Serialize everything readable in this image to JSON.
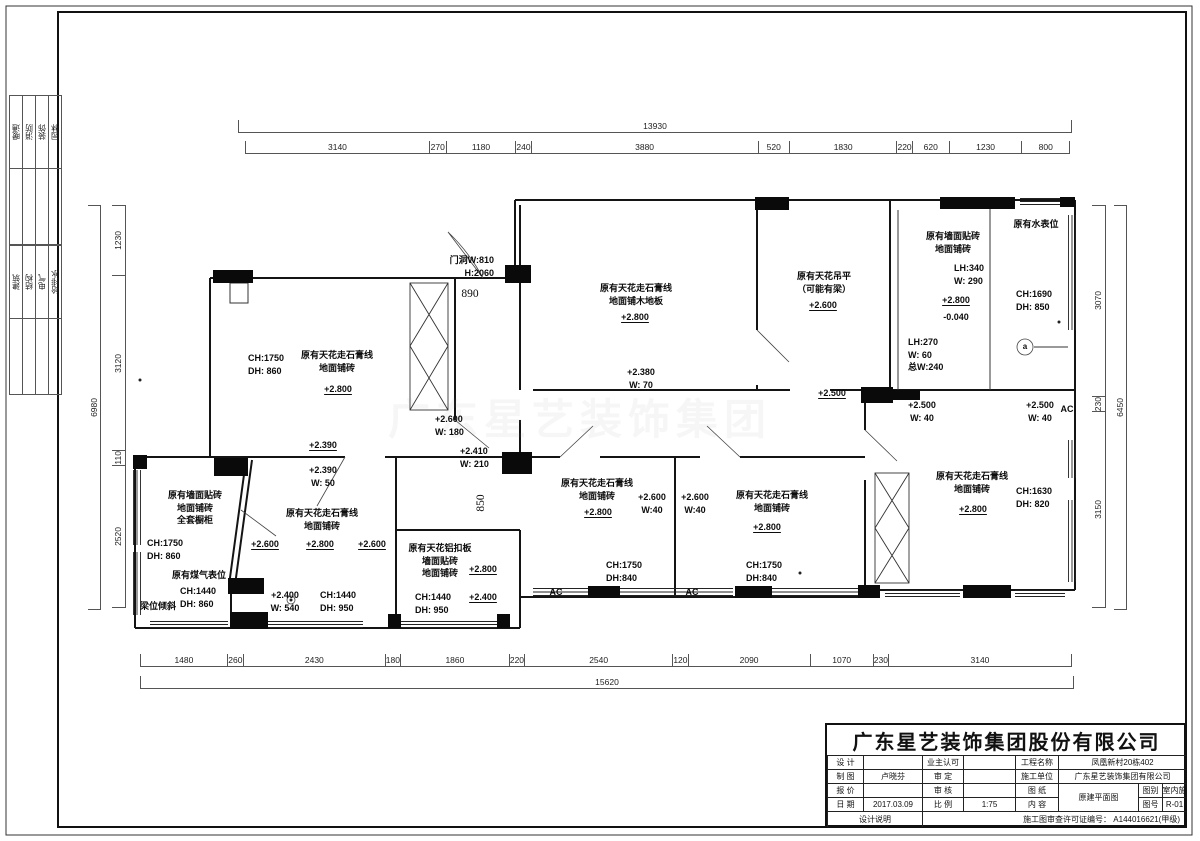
{
  "page": {
    "watermark": "广东星艺装饰集团",
    "margin_disciplines_group1": [
      {
        "t": "暖通"
      },
      {
        "t": "消防"
      },
      {
        "t": "装饰"
      },
      {
        "t": "园林"
      }
    ],
    "margin_disciplines_group2": [
      {
        "t": "建筑"
      },
      {
        "t": "结构"
      },
      {
        "t": "电气"
      },
      {
        "t": "给排水"
      }
    ]
  },
  "dims": {
    "top": {
      "total": "13930",
      "segments": [
        {
          "label": "3140",
          "mm": 3140
        },
        {
          "label": "270",
          "mm": 270
        },
        {
          "label": "1180",
          "mm": 1180
        },
        {
          "label": "240",
          "mm": 240
        },
        {
          "label": "3880",
          "mm": 3880
        },
        {
          "label": "520",
          "mm": 520
        },
        {
          "label": "1830",
          "mm": 1830
        },
        {
          "label": "220",
          "mm": 220
        },
        {
          "label": "620",
          "mm": 620
        },
        {
          "label": "1230",
          "mm": 1230
        },
        {
          "label": "800",
          "mm": 800
        }
      ]
    },
    "bottom": {
      "total": "15620",
      "segments": [
        {
          "label": "1480",
          "mm": 1480
        },
        {
          "label": "260",
          "mm": 260
        },
        {
          "label": "2430",
          "mm": 2430
        },
        {
          "label": "180",
          "mm": 180
        },
        {
          "label": "1860",
          "mm": 1860
        },
        {
          "label": "220",
          "mm": 220
        },
        {
          "label": "2540",
          "mm": 2540
        },
        {
          "label": "120",
          "mm": 120
        },
        {
          "label": "2090",
          "mm": 2090
        },
        {
          "label": "1070",
          "mm": 1070
        },
        {
          "label": "230",
          "mm": 230
        },
        {
          "label": "3140",
          "mm": 3140
        }
      ]
    },
    "left": {
      "total": "6980",
      "segments": [
        {
          "label": "1230",
          "mm": 1230
        },
        {
          "label": "3120",
          "mm": 3120
        },
        {
          "label": "110",
          "mm": 110
        },
        {
          "label": "2520",
          "mm": 2520
        }
      ]
    },
    "right": {
      "total": "6450",
      "segments": [
        {
          "label": "3070",
          "mm": 3070
        },
        {
          "label": "230",
          "mm": 230
        },
        {
          "label": "3150",
          "mm": 3150
        }
      ]
    }
  },
  "plan_labels": [
    {
      "t": "门洞W:810\nH:2060",
      "x": 438,
      "y": 254,
      "w": 56,
      "cls": "right"
    },
    {
      "t": "890",
      "x": 450,
      "y": 286,
      "w": 40,
      "cls": "serif"
    },
    {
      "t": "CH:1750\nDH: 860",
      "x": 248,
      "y": 352,
      "w": 48,
      "cls": "left"
    },
    {
      "t": "原有天花走石膏线\n地面铺砖",
      "x": 293,
      "y": 349,
      "w": 88
    },
    {
      "t": "+2.800",
      "x": 315,
      "y": 383,
      "w": 46,
      "cls": "elev"
    },
    {
      "t": "+2.600\nW: 180",
      "x": 435,
      "y": 413,
      "w": 48,
      "cls": "left"
    },
    {
      "t": "+2.410\nW: 210",
      "x": 460,
      "y": 445,
      "w": 48,
      "cls": "left"
    },
    {
      "t": "+2.390",
      "x": 300,
      "y": 439,
      "w": 46,
      "cls": "elev"
    },
    {
      "t": "+2.390\nW: 50",
      "x": 298,
      "y": 464,
      "w": 50
    },
    {
      "t": "850",
      "x": 466,
      "y": 495,
      "w": 30,
      "cls": "serif vert"
    },
    {
      "t": "原有天花走石膏线\n地面铺木地板",
      "x": 588,
      "y": 282,
      "w": 96
    },
    {
      "t": "+2.800",
      "x": 612,
      "y": 311,
      "w": 46,
      "cls": "elev"
    },
    {
      "t": "+2.380\nW: 70",
      "x": 616,
      "y": 366,
      "w": 50
    },
    {
      "t": "原有天花吊平\n（可能有梁）",
      "x": 786,
      "y": 270,
      "w": 76
    },
    {
      "t": "+2.600",
      "x": 800,
      "y": 299,
      "w": 46,
      "cls": "elev"
    },
    {
      "t": "+2.500",
      "x": 810,
      "y": 387,
      "w": 44,
      "cls": "elev"
    },
    {
      "t": "原有墙面贴砖\n地面铺砖",
      "x": 918,
      "y": 230,
      "w": 70
    },
    {
      "t": "原有水表位",
      "x": 1006,
      "y": 218,
      "w": 60
    },
    {
      "t": "LH:340\nW: 290",
      "x": 954,
      "y": 262,
      "w": 44,
      "cls": "left"
    },
    {
      "t": "+2.800",
      "x": 933,
      "y": 294,
      "w": 46,
      "cls": "elev"
    },
    {
      "t": "-0.040",
      "x": 933,
      "y": 311,
      "w": 46
    },
    {
      "t": "CH:1690\nDH: 850",
      "x": 1016,
      "y": 288,
      "w": 48,
      "cls": "left"
    },
    {
      "t": "LH:270\nW:  60\n总W:240",
      "x": 908,
      "y": 336,
      "w": 50,
      "cls": "left"
    },
    {
      "t": "a",
      "x": 1017,
      "y": 341,
      "w": 16,
      "cls": "small"
    },
    {
      "t": "+2.500\nW: 40",
      "x": 898,
      "y": 399,
      "w": 48
    },
    {
      "t": "+2.500\nW: 40",
      "x": 1016,
      "y": 399,
      "w": 48
    },
    {
      "t": "AC",
      "x": 1056,
      "y": 403,
      "w": 22
    },
    {
      "t": "原有天花走石膏线\n地面铺砖",
      "x": 928,
      "y": 470,
      "w": 88
    },
    {
      "t": "+2.800",
      "x": 950,
      "y": 503,
      "w": 46,
      "cls": "elev"
    },
    {
      "t": "CH:1630\nDH: 820",
      "x": 1016,
      "y": 485,
      "w": 48,
      "cls": "left"
    },
    {
      "t": "原有天花走石膏线\n地面铺砖",
      "x": 553,
      "y": 477,
      "w": 88
    },
    {
      "t": "+2.800",
      "x": 575,
      "y": 506,
      "w": 46,
      "cls": "elev"
    },
    {
      "t": "+2.600\nW:40",
      "x": 633,
      "y": 491,
      "w": 38
    },
    {
      "t": "+2.600\nW:40",
      "x": 676,
      "y": 491,
      "w": 38
    },
    {
      "t": "CH:1750\nDH:840",
      "x": 606,
      "y": 559,
      "w": 46,
      "cls": "left"
    },
    {
      "t": "AC",
      "x": 546,
      "y": 586,
      "w": 20
    },
    {
      "t": "AC",
      "x": 682,
      "y": 586,
      "w": 20
    },
    {
      "t": "原有天花走石膏线\n地面铺砖",
      "x": 728,
      "y": 489,
      "w": 88
    },
    {
      "t": "+2.800",
      "x": 744,
      "y": 521,
      "w": 46,
      "cls": "elev"
    },
    {
      "t": "CH:1750\nDH:840",
      "x": 746,
      "y": 559,
      "w": 46,
      "cls": "left"
    },
    {
      "t": "原有墙面贴砖\n地面铺砖\n全套橱柜",
      "x": 158,
      "y": 489,
      "w": 74
    },
    {
      "t": "CH:1750\nDH: 860",
      "x": 147,
      "y": 537,
      "w": 48,
      "cls": "left"
    },
    {
      "t": "原有煤气表位",
      "x": 164,
      "y": 569,
      "w": 70
    },
    {
      "t": "CH:1440\nDH: 860",
      "x": 180,
      "y": 585,
      "w": 48,
      "cls": "left"
    },
    {
      "t": "梁位倾斜",
      "x": 135,
      "y": 600,
      "w": 46
    },
    {
      "t": "原有天花走石膏线\n地面铺砖",
      "x": 278,
      "y": 507,
      "w": 88
    },
    {
      "t": "+2.600",
      "x": 245,
      "y": 538,
      "w": 40,
      "cls": "elev"
    },
    {
      "t": "+2.800",
      "x": 300,
      "y": 538,
      "w": 40,
      "cls": "elev"
    },
    {
      "t": "+2.600",
      "x": 352,
      "y": 538,
      "w": 40,
      "cls": "elev"
    },
    {
      "t": "+2.400\nW: 540",
      "x": 261,
      "y": 589,
      "w": 48
    },
    {
      "t": "CH:1440\nDH: 950",
      "x": 320,
      "y": 589,
      "w": 48,
      "cls": "left"
    },
    {
      "t": "原有天花铝扣板\n墙面贴砖\n地面铺砖",
      "x": 401,
      "y": 542,
      "w": 78
    },
    {
      "t": "+2.800",
      "x": 461,
      "y": 563,
      "w": 44,
      "cls": "elev"
    },
    {
      "t": "CH:1440\nDH: 950",
      "x": 415,
      "y": 591,
      "w": 48,
      "cls": "left"
    },
    {
      "t": "+2.400",
      "x": 461,
      "y": 591,
      "w": 44,
      "cls": "elev"
    }
  ],
  "title_block": {
    "company": "广东星艺装饰集团股份有限公司",
    "labels": {
      "design": "设 计",
      "draw": "制 图",
      "price": "报 价",
      "date": "日 期",
      "owner": "业主认可",
      "verify": "审 定",
      "check": "审 核",
      "scale": "比 例",
      "project": "工程名称",
      "contractor": "施工单位",
      "sheet": "图 纸",
      "content": "内 容",
      "category": "图别",
      "number": "图号",
      "notes": "设计说明"
    },
    "values": {
      "drafter": "卢晓芬",
      "date": "2017.03.09",
      "scale": "1:75",
      "project": "凤凰新村20栋402",
      "contractor": "广东星艺装饰集团有限公司",
      "content": "原建平面图",
      "category": "室内施",
      "number": "R-01",
      "permit": "施工图审查许可证编号： A144016621(甲级)"
    }
  }
}
